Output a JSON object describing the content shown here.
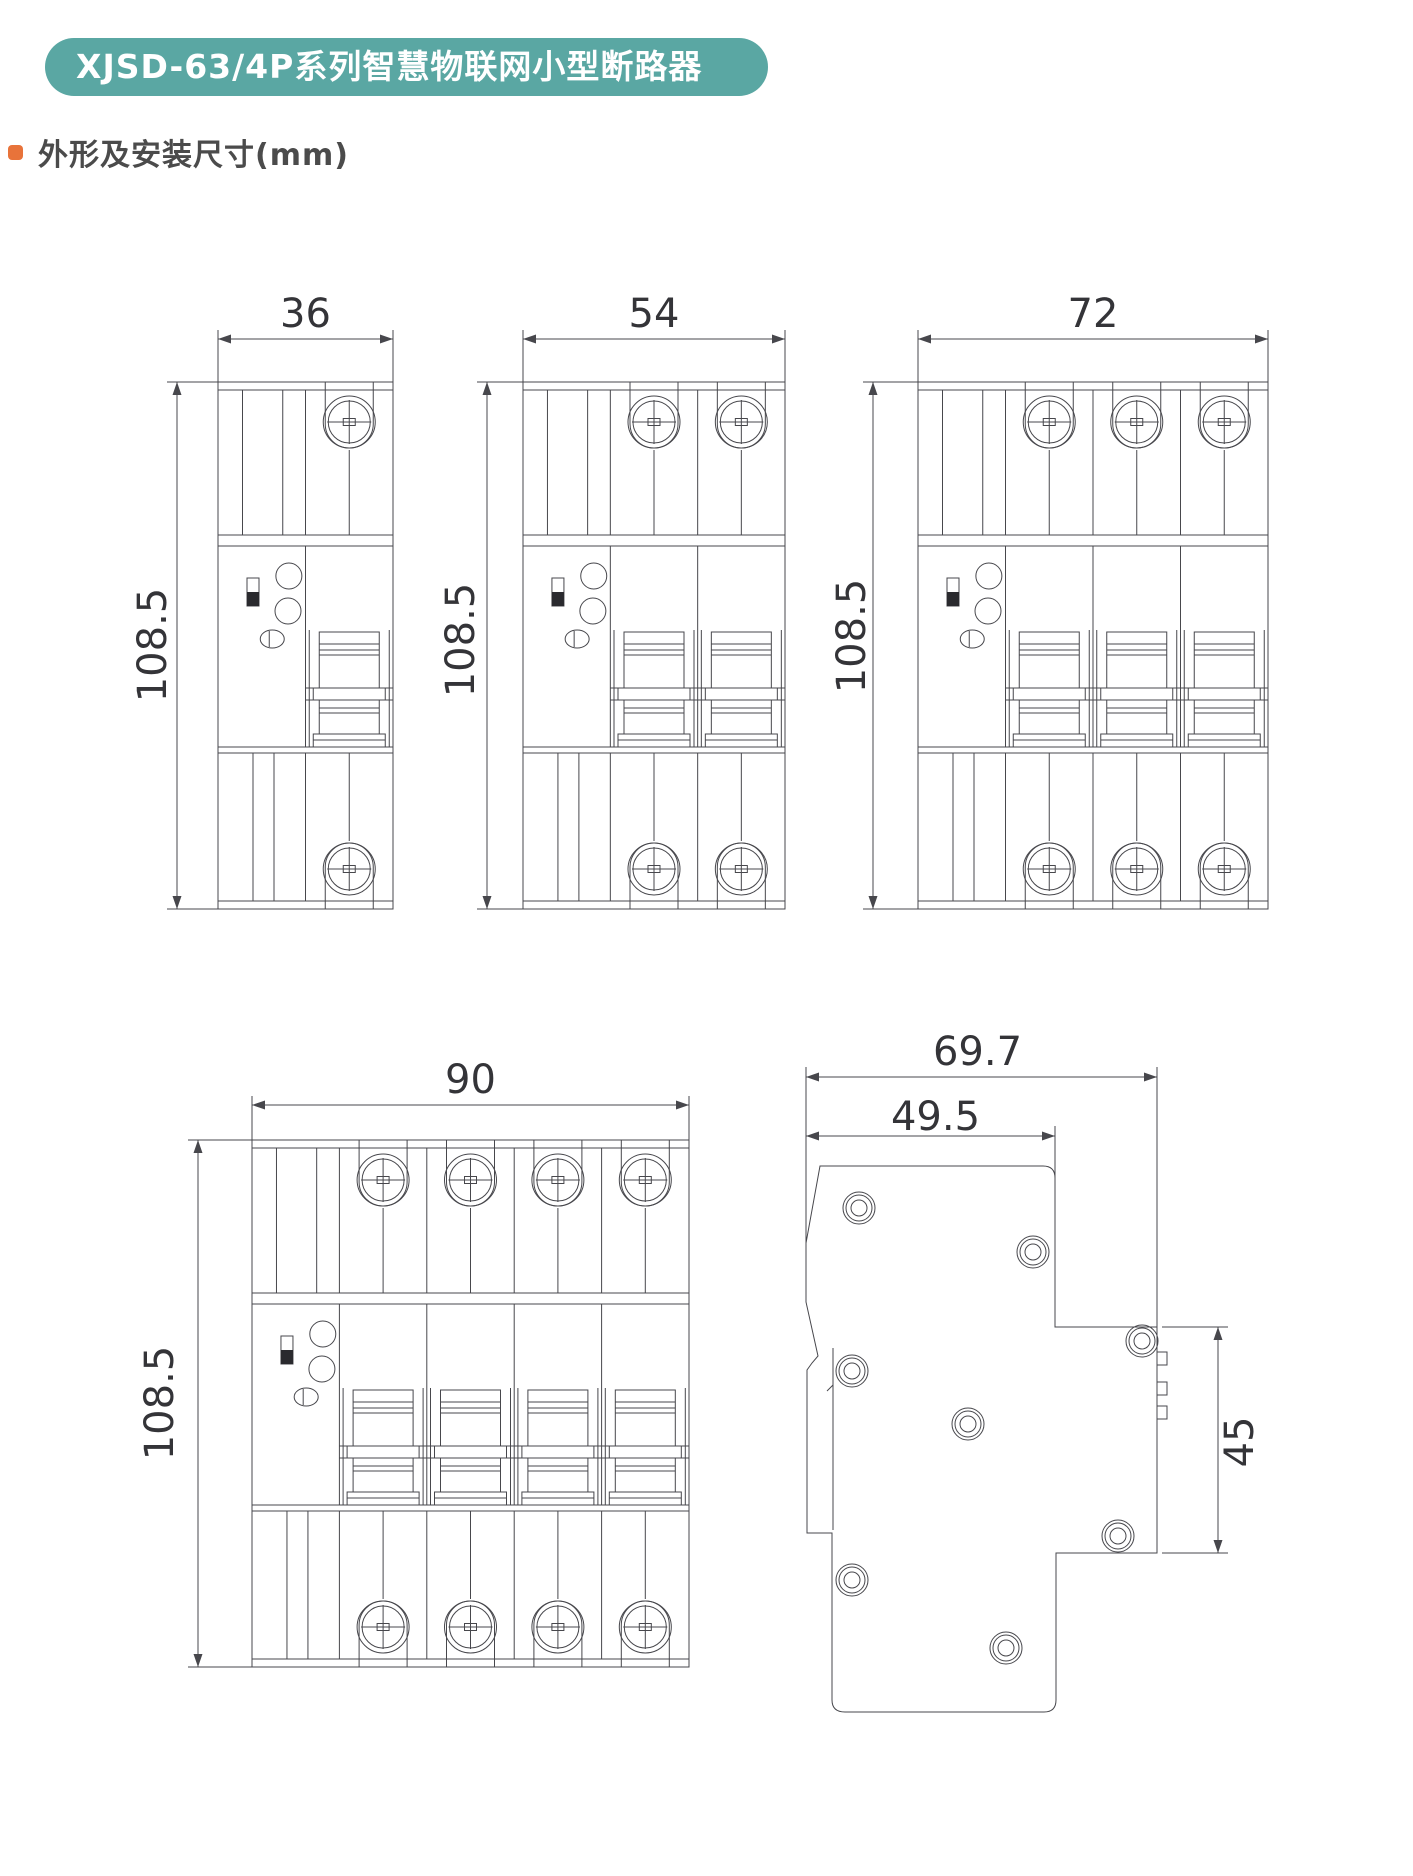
{
  "header": {
    "banner_title": "XJSD-63/4P系列智慧物联网小型断路器"
  },
  "section": {
    "title": "外形及安装尺寸(mm)"
  },
  "colors": {
    "banner_bg": "#5aa7a3",
    "bullet": "#e8733a",
    "line": "#47474c",
    "dim_text": "#343438"
  },
  "front_views": [
    {
      "name": "front-view-1-pole",
      "poles": 1,
      "width_mm": "36",
      "height_mm": "108.5"
    },
    {
      "name": "front-view-2-pole",
      "poles": 2,
      "width_mm": "54",
      "height_mm": "108.5"
    },
    {
      "name": "front-view-3-pole",
      "poles": 3,
      "width_mm": "72",
      "height_mm": "108.5"
    },
    {
      "name": "front-view-4-pole",
      "poles": 4,
      "width_mm": "90",
      "height_mm": "108.5"
    }
  ],
  "side_view": {
    "name": "side-view",
    "total_depth_mm": "69.7",
    "upper_depth_mm": "49.5",
    "terminal_height_mm": "45"
  }
}
